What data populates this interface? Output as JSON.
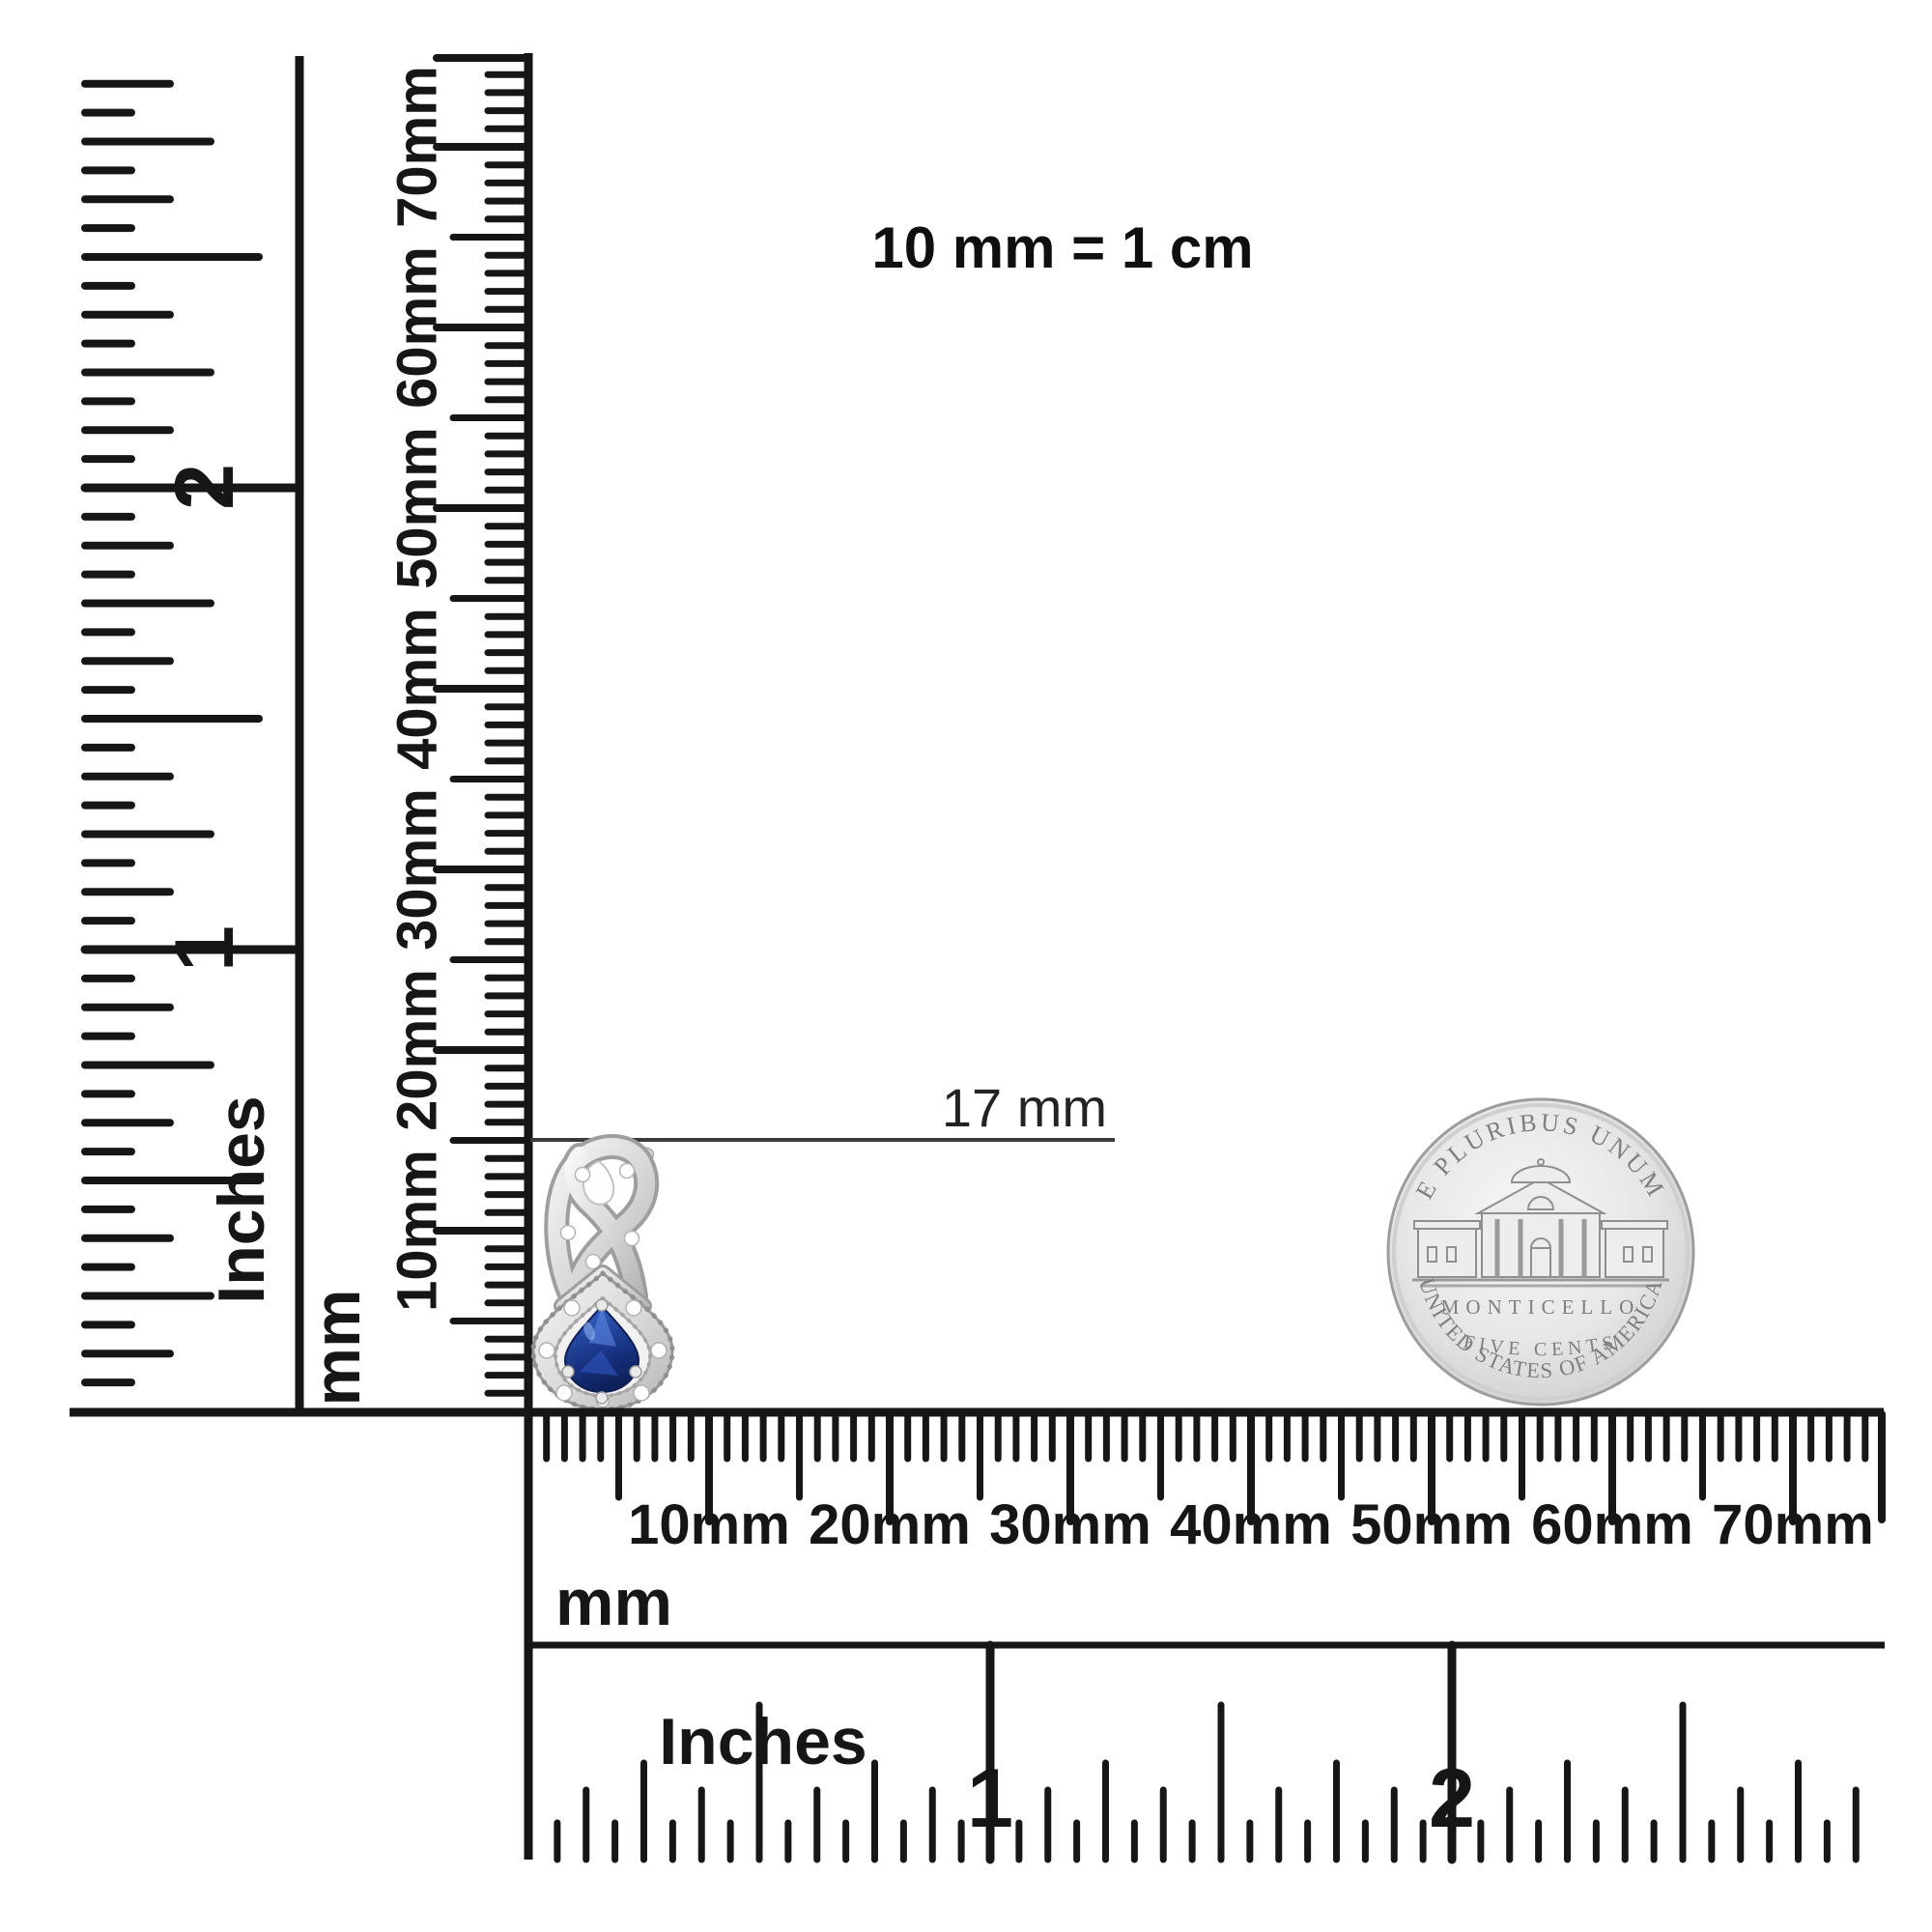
{
  "equivalence_note": "10 mm = 1 cm",
  "annotation": {
    "label": "17 mm"
  },
  "rulers": {
    "vertical_inches": {
      "unit_label": "Inches",
      "tick_labels": [
        "1",
        "2"
      ]
    },
    "vertical_mm": {
      "unit_label": "mm",
      "tick_labels": [
        "10mm",
        "20mm",
        "30mm",
        "40mm",
        "50mm",
        "60mm",
        "70mm"
      ]
    },
    "horizontal_mm": {
      "unit_label": "mm",
      "tick_labels": [
        "10mm",
        "20mm",
        "30mm",
        "40mm",
        "50mm",
        "60mm",
        "70mm"
      ]
    },
    "horizontal_inches": {
      "unit_label": "Inches",
      "tick_labels": [
        "1",
        "2"
      ]
    }
  },
  "coin": {
    "top_legend": "E PLURIBUS UNUM",
    "building_label": "MONTICELLO",
    "denomination": "FIVE CENTS",
    "bottom_legend": "UNITED STATES OF AMERICA"
  },
  "colors": {
    "background": "#ffffff",
    "ruler_ink": "#161616",
    "annotation_line": "#3a3a3a",
    "annotation_text": "#232323",
    "note_text": "#0f0f0f",
    "coin_face": "#e3e3e3",
    "coin_rim": "#9d9d9d",
    "coin_engraving": "#7f7f7f",
    "metal_silver": "#cccccc",
    "sapphire_blue": "#1d3f9e",
    "diamond_white": "#ffffff"
  }
}
